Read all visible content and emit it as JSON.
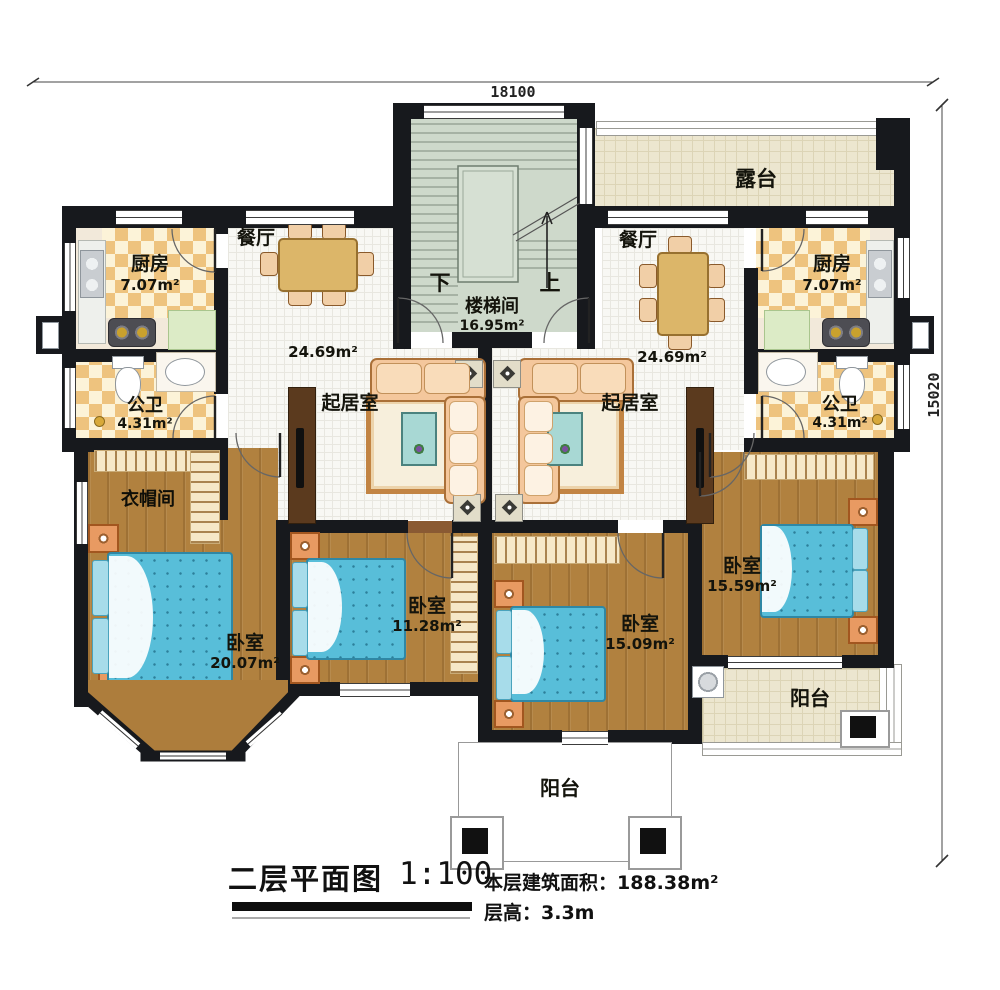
{
  "dimensions": {
    "width": "18100",
    "height": "15020"
  },
  "rooms": {
    "terrace": {
      "label": "露台"
    },
    "stairwell": {
      "label": "楼梯间",
      "area": "16.95m²",
      "down": "下",
      "up": "上"
    },
    "kitchen_left": {
      "label": "厨房",
      "area": "7.07m²"
    },
    "kitchen_right": {
      "label": "厨房",
      "area": "7.07m²"
    },
    "dining_left": {
      "label": "餐厅",
      "area": "24.69m²"
    },
    "dining_right": {
      "label": "餐厅",
      "area": "24.69m²"
    },
    "living_left": {
      "label": "起居室"
    },
    "living_right": {
      "label": "起居室"
    },
    "bath_left": {
      "label": "公卫",
      "area": "4.31m²"
    },
    "bath_right": {
      "label": "公卫",
      "area": "4.31m²"
    },
    "cloakroom": {
      "label": "衣帽间"
    },
    "bedroom_sw": {
      "label": "卧室",
      "area": "20.07m²"
    },
    "bedroom_s1": {
      "label": "卧室",
      "area": "11.28m²"
    },
    "bedroom_s2": {
      "label": "卧室",
      "area": "15.09m²"
    },
    "bedroom_se": {
      "label": "卧室",
      "area": "15.59m²"
    },
    "balcony_south": {
      "label": "阳台"
    },
    "balcony_east": {
      "label": "阳台"
    }
  },
  "title": {
    "name": "二层平面图",
    "scale": "1:100",
    "floor_area": "本层建筑面积：188.38m²",
    "floor_height": "层高：3.3m"
  },
  "colors": {
    "wall": "#17191d",
    "wood_floor": "#b1813f",
    "tile_a": "#eec37e",
    "tile_b": "#fcf3d8",
    "white_floor": "#f8f8f4",
    "terrace_floor": "#ece6cf",
    "stair_floor": "#ced9cb",
    "bed": "#58bed9",
    "sofa": "#f4c79c",
    "table": "#dcb669"
  }
}
